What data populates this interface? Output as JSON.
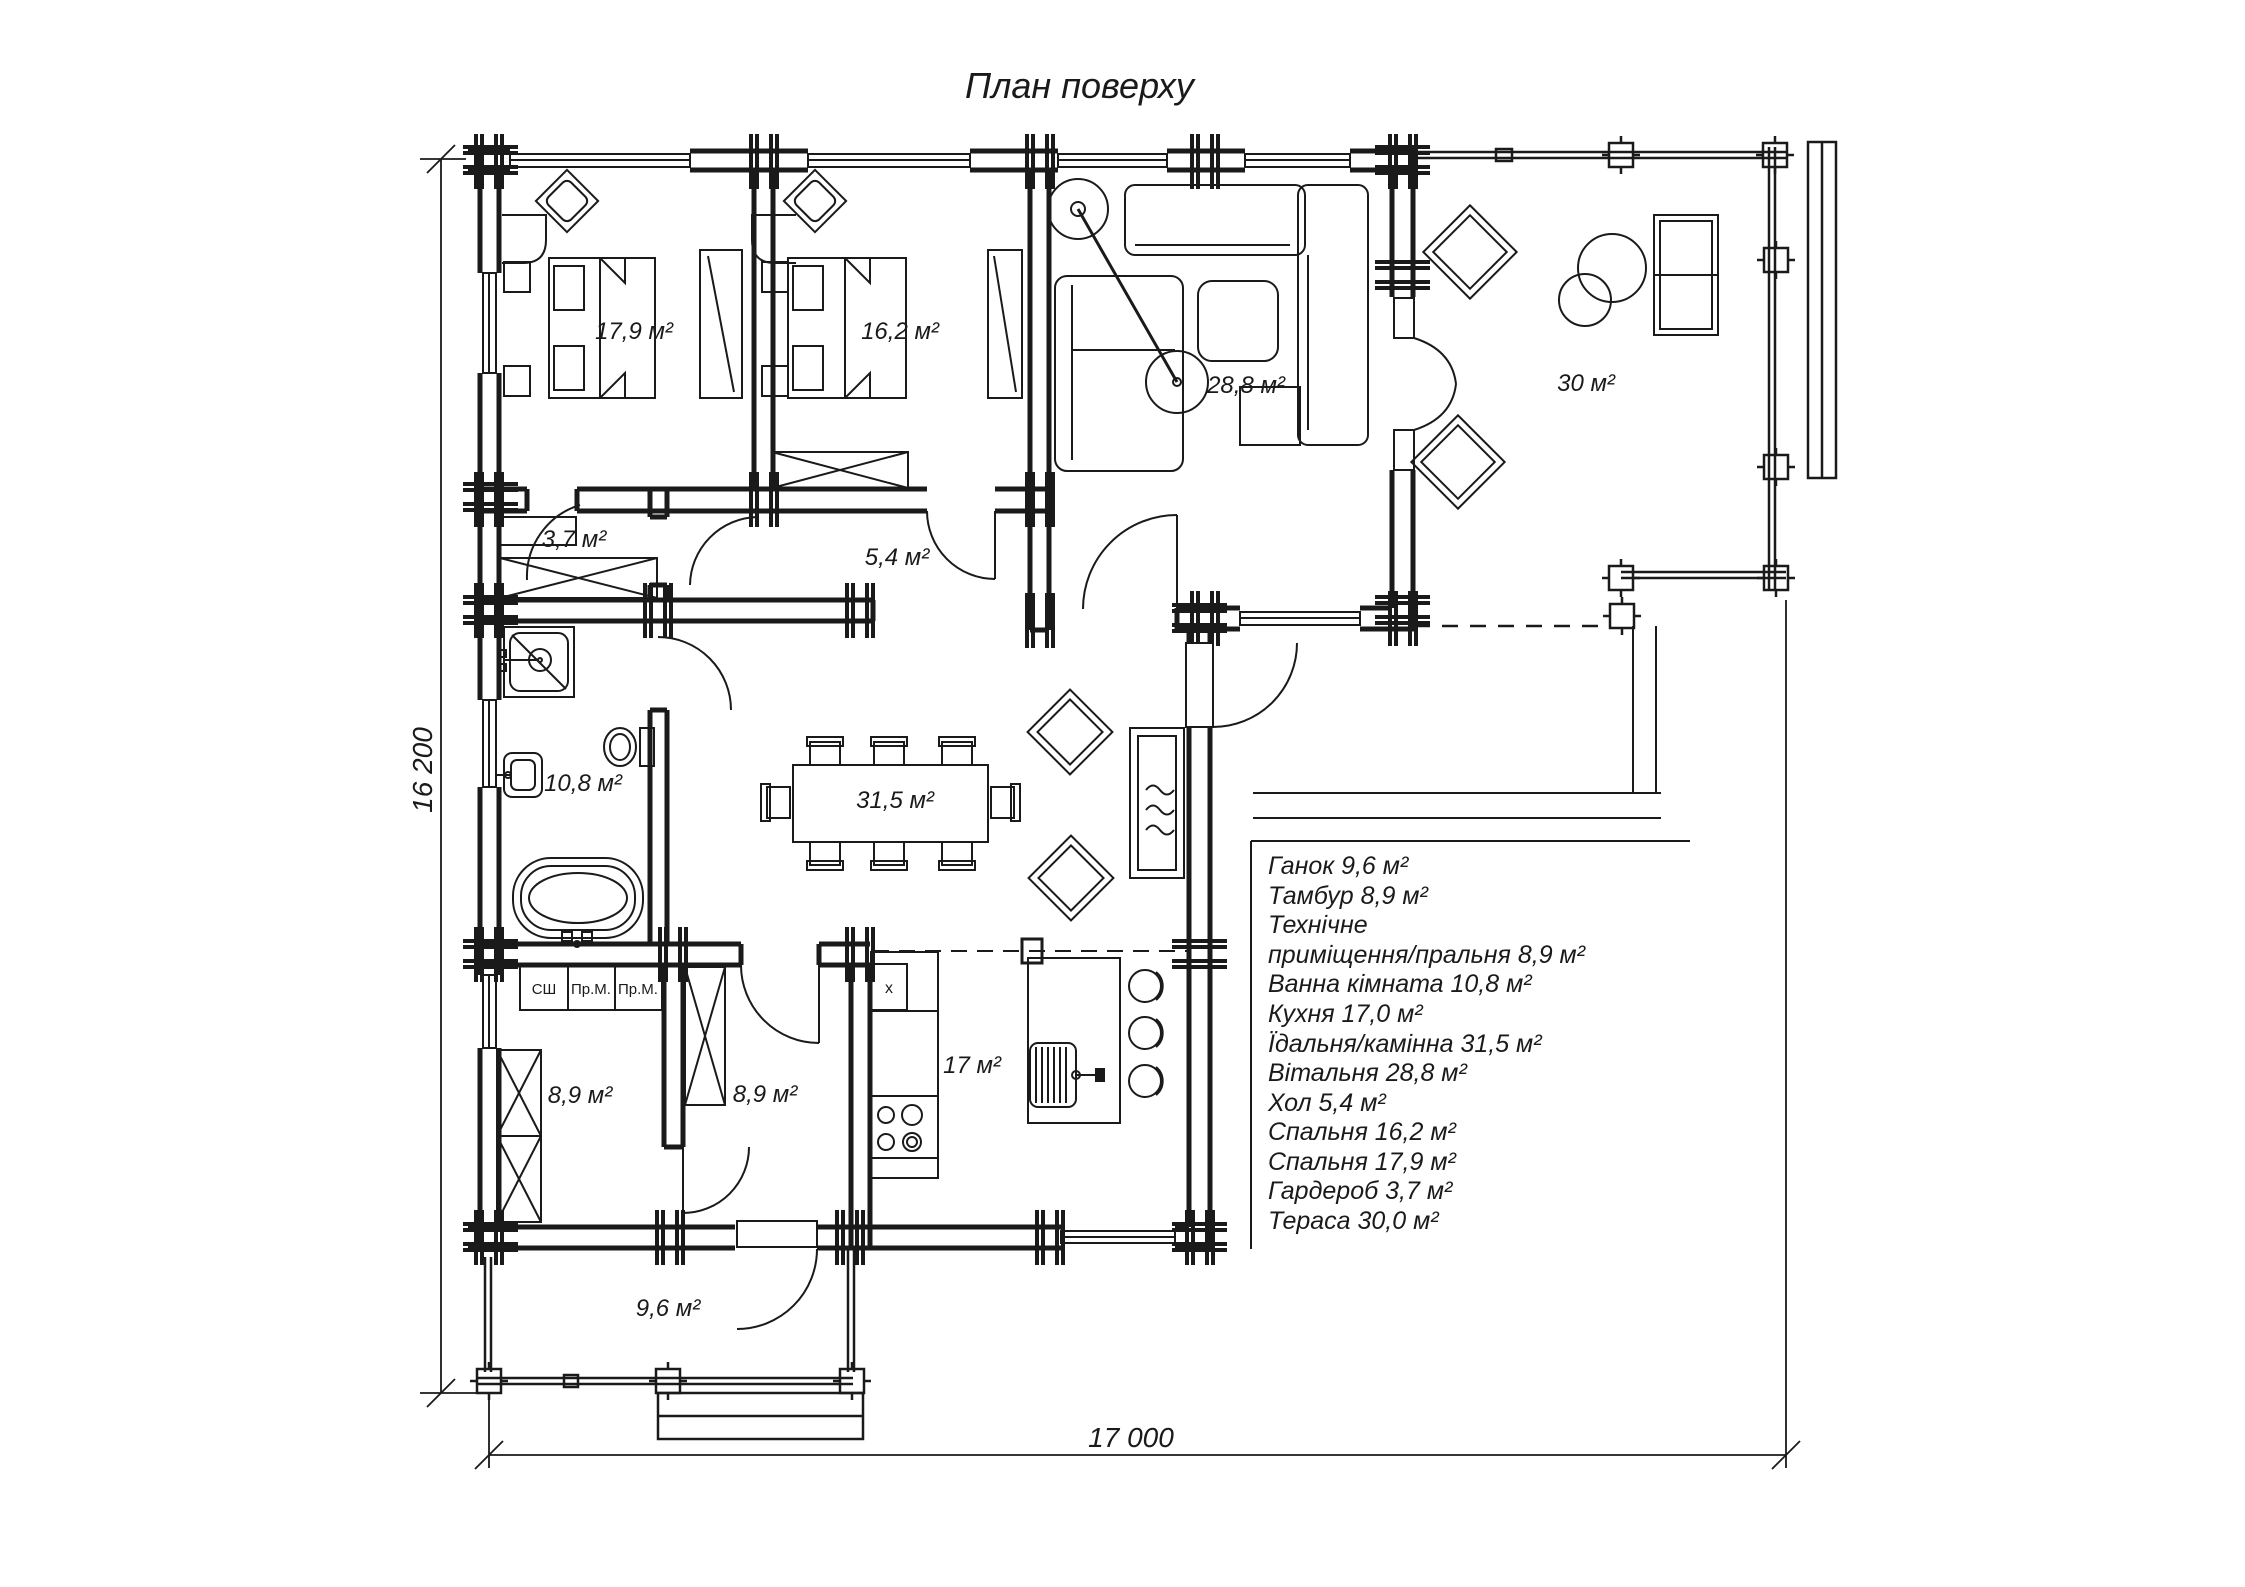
{
  "title": "План поверху",
  "colors": {
    "line": "#1a1a1a",
    "background": "#ffffff"
  },
  "dimensions": {
    "height_label": "16 200",
    "width_label": "17 000"
  },
  "rooms": {
    "bedroom1": "17,9 м²",
    "bedroom2": "16,2 м²",
    "living": "28,8 м²",
    "terrace": "30 м²",
    "wardrobe": "3,7 м²",
    "hall": "5,4 м²",
    "bathroom": "10,8 м²",
    "dining": "31,5 м²",
    "tech": "8,9 м²",
    "tambour": "8,9 м²",
    "kitchen": "17 м²",
    "porch": "9,6 м²"
  },
  "cabinet_labels": [
    "СШ",
    "Пр.М.",
    "Пр.М."
  ],
  "counter_mark": "х",
  "legend": [
    "Ганок 9,6 м²",
    "Тамбур 8,9 м²",
    "Технічне",
    "приміщення/пральня 8,9 м²",
    "Ванна кімната 10,8 м²",
    "Кухня 17,0 м²",
    "Їдальня/камінна 31,5 м²",
    "Вітальня 28,8 м²",
    "Хол 5,4 м²",
    "Спальня 16,2 м²",
    "Спальня 17,9 м²",
    "Гардероб 3,7 м²",
    "Тераса 30,0 м²"
  ]
}
